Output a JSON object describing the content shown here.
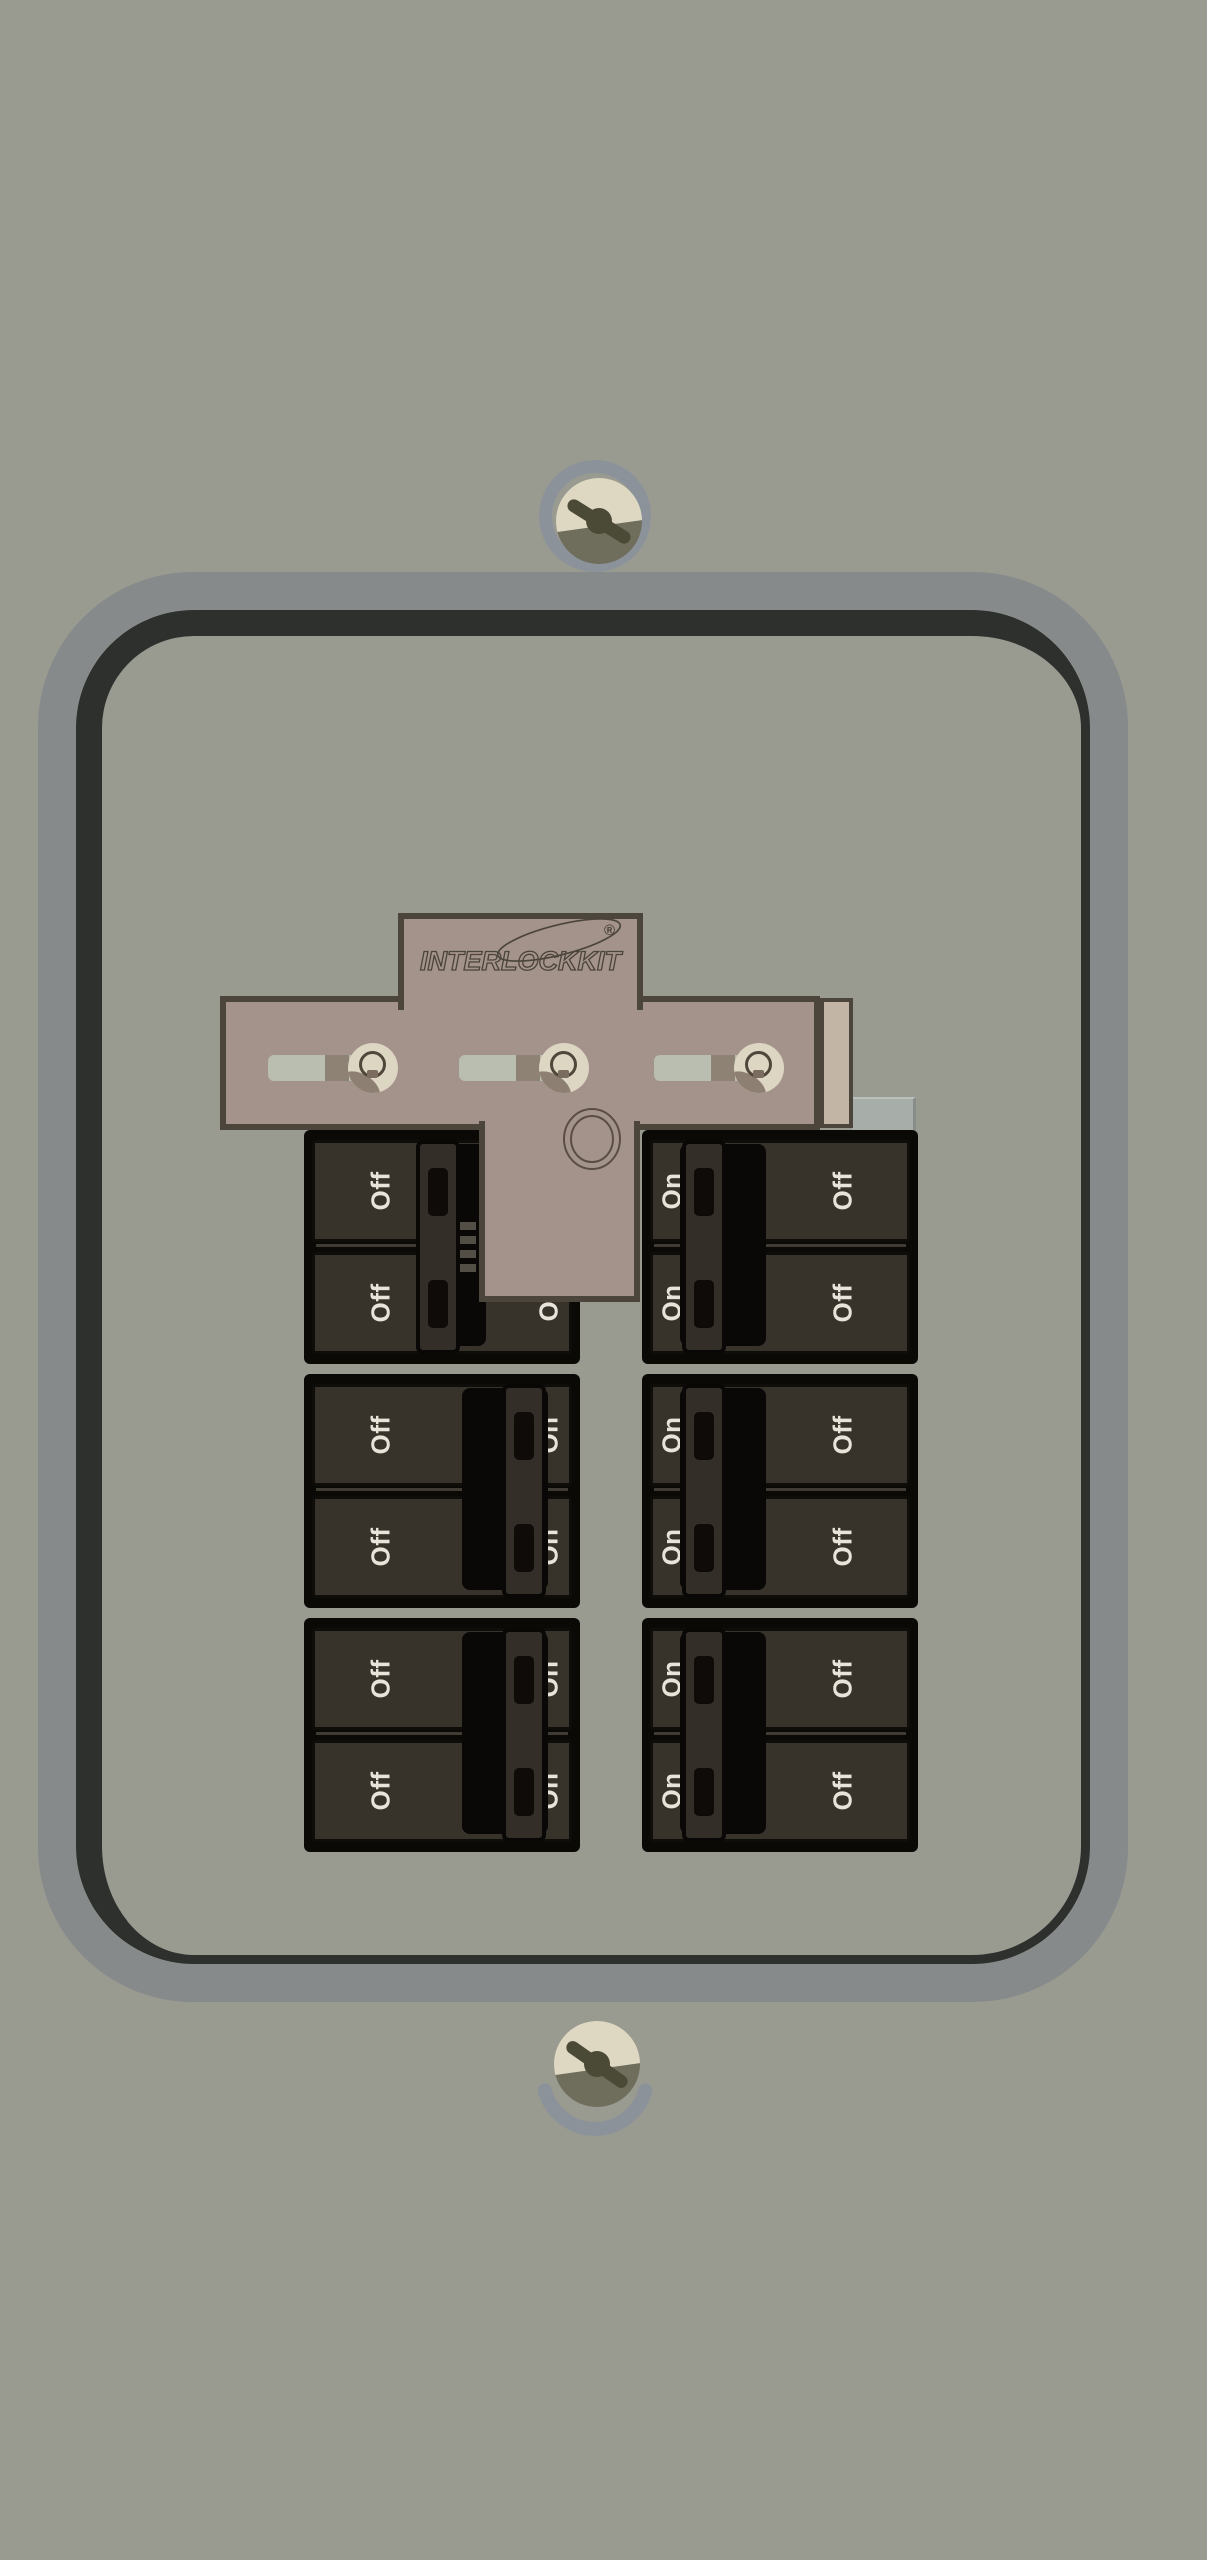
{
  "device": {
    "type": "circuit breaker panel with generator interlock kit"
  },
  "logo": {
    "brand": "INTERLOCKKIT",
    "registered_mark": "®"
  },
  "left_column": {
    "pair_positions": [
      "off",
      "on",
      "on"
    ],
    "rows": [
      {
        "off": "Off",
        "on": "On"
      },
      {
        "off": "Off",
        "on": "On"
      },
      {
        "off": "Off",
        "on": "On"
      },
      {
        "off": "Off",
        "on": "On"
      },
      {
        "off": "Off",
        "on": "On"
      },
      {
        "off": "Off",
        "on": "On"
      }
    ]
  },
  "right_column": {
    "pair_positions": [
      "on",
      "on",
      "on"
    ],
    "rows": [
      {
        "on": "On",
        "off": "Off"
      },
      {
        "on": "On",
        "off": "Off"
      },
      {
        "on": "On",
        "off": "Off"
      },
      {
        "on": "On",
        "off": "Off"
      },
      {
        "on": "On",
        "off": "Off"
      },
      {
        "on": "On",
        "off": "Off"
      }
    ]
  },
  "interlock": {
    "slider_count": 3
  },
  "colors": {
    "background": "#999b91",
    "door_frame": "#868a8b",
    "door_frame_shadow": "#2d302d",
    "interlock_plate": "#a4938a",
    "plate_border": "#4b453c",
    "plate_side_strip": "#c3b5a6",
    "breaker_body": "#0b0906",
    "breaker_face": "#37332b",
    "breaker_handle": "#332f28",
    "label_text": "#e9e4d9",
    "slider_track": "#b9beb1",
    "slider_knob": "#ddd6c3",
    "screw_ring": "#8c929a",
    "screw_head_light": "#ded8c2",
    "screw_head_dark": "#6f6d5c"
  }
}
